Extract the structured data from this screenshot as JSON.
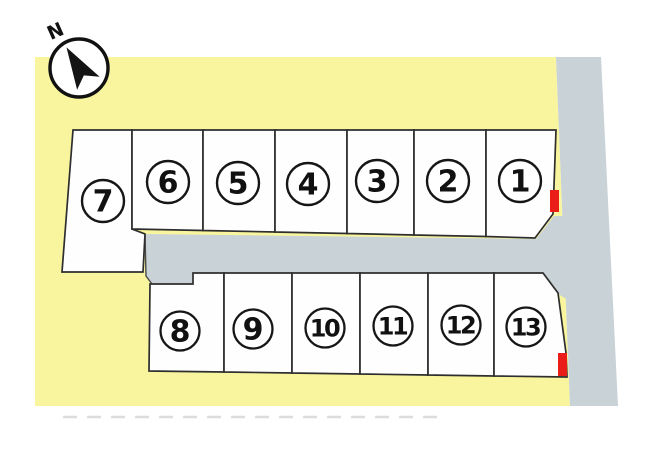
{
  "plan": {
    "compass_label": "N",
    "lots": [
      {
        "label": "1"
      },
      {
        "label": "2"
      },
      {
        "label": "3"
      },
      {
        "label": "4"
      },
      {
        "label": "5"
      },
      {
        "label": "6"
      },
      {
        "label": "7"
      },
      {
        "label": "8"
      },
      {
        "label": "9"
      },
      {
        "label": "10"
      },
      {
        "label": "11"
      },
      {
        "label": "12"
      },
      {
        "label": "13"
      }
    ],
    "colors": {
      "parcel_yellow": "#f8f59e",
      "road_gray": "#c9d2d7",
      "lot_fill": "#fefefe",
      "outline_black": "#2e2e2e",
      "marker_red": "#ea1d18"
    }
  }
}
